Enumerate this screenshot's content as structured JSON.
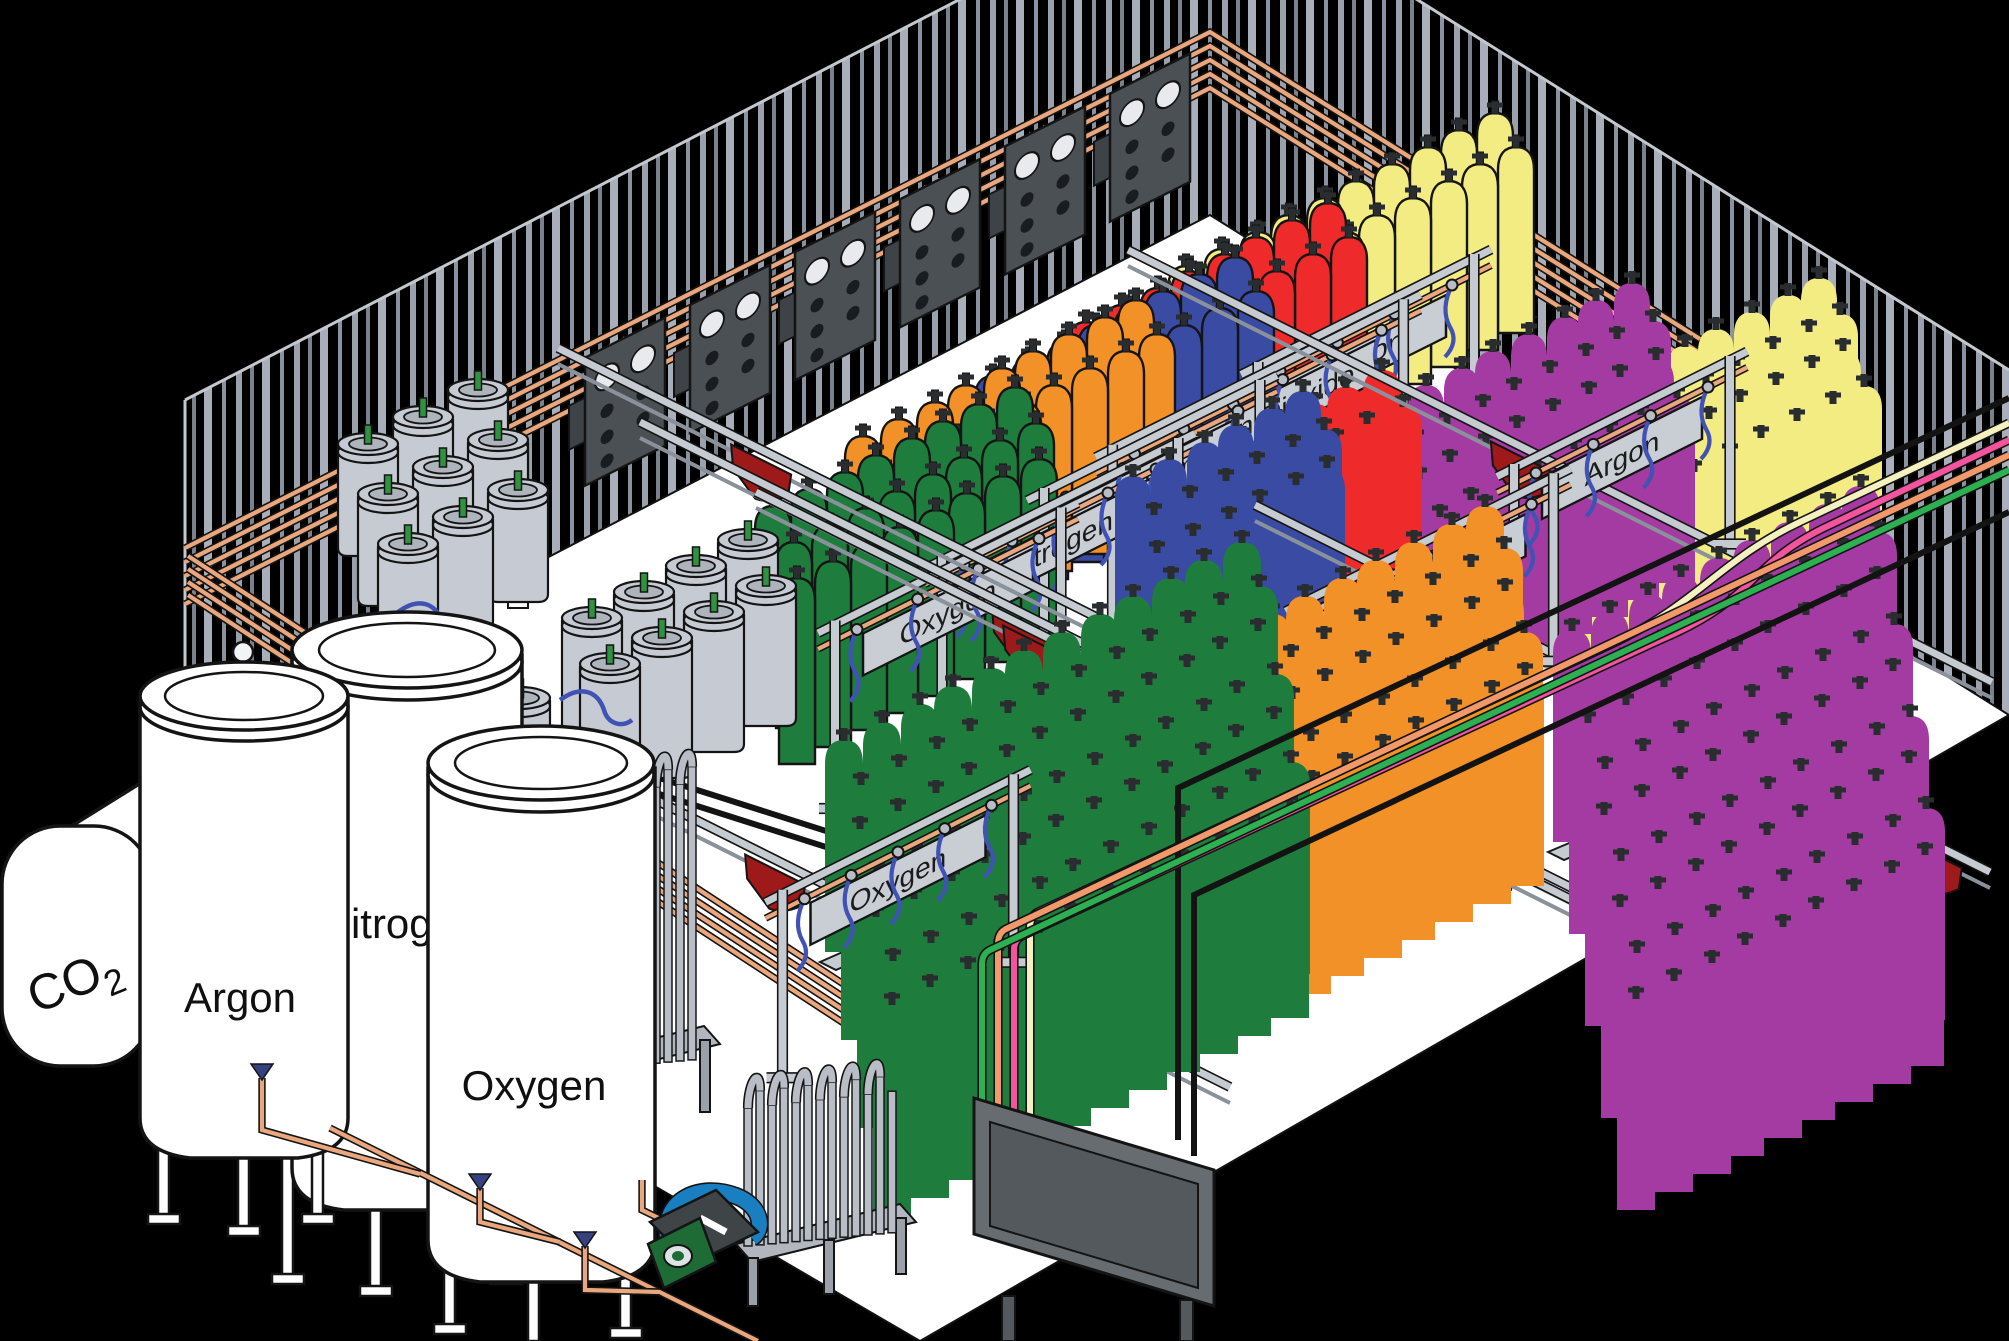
{
  "tanks": {
    "co2": {
      "text": "CO",
      "sub": "2"
    },
    "argon": {
      "label": "Argon"
    },
    "nitrogen": {
      "label": "Nitrogen"
    },
    "oxygen": {
      "label": "Oxygen"
    }
  },
  "stations": [
    {
      "id": "oxygen-1",
      "label": "Oxygen",
      "cylinder_color": "orange"
    },
    {
      "id": "nitrogen-1",
      "label": "Nitrogen",
      "cylinder_color": "blue"
    },
    {
      "id": "helium",
      "label": "Helium",
      "cylinder_color": "red"
    },
    {
      "id": "carbon-dioxide",
      "label": "Carbon Dioxide",
      "cylinder_color": "pale-yellow"
    },
    {
      "id": "argon-1",
      "label": "Argon",
      "cylinder_color": "pale-yellow"
    },
    {
      "id": "hydrogen",
      "label": "Hydrogen",
      "cylinder_color": "purple"
    },
    {
      "id": "nitrogen-2",
      "label": "Nitrogen",
      "cylinder_color": "blue"
    },
    {
      "id": "oxygen-2",
      "label": "Oxygen",
      "cylinder_color": "green"
    },
    {
      "id": "argon-2",
      "label": "Argon",
      "cylinder_color": "pale-yellow"
    }
  ],
  "colors": {
    "background": "#000000",
    "floor": "#FFFFFF",
    "wall_stripe": "#9AA1AC",
    "cylinder_green": "#1E7D3D",
    "cylinder_orange": "#F29127",
    "cylinder_blue": "#3A4BA3",
    "cylinder_red": "#EE2A2A",
    "cylinder_yellow": "#F2EC82",
    "cylinder_purple": "#A43BA3",
    "copper_pipe": "#EAA77E",
    "line_cream": "#F5F0C0",
    "line_pink": "#F2549E",
    "line_salmon": "#F2996B",
    "line_green": "#2DB052",
    "flag_red": "#9E1A1A",
    "sign_plate": "#C9CDD4",
    "dewar_gray": "#C6CAD2",
    "platform_blue": "#35427F",
    "hose_blue": "#4053B4",
    "pigtail_yellow": "#F2D51D",
    "pump_blue": "#1A7FC0",
    "pump_green": "#1E6B36"
  }
}
